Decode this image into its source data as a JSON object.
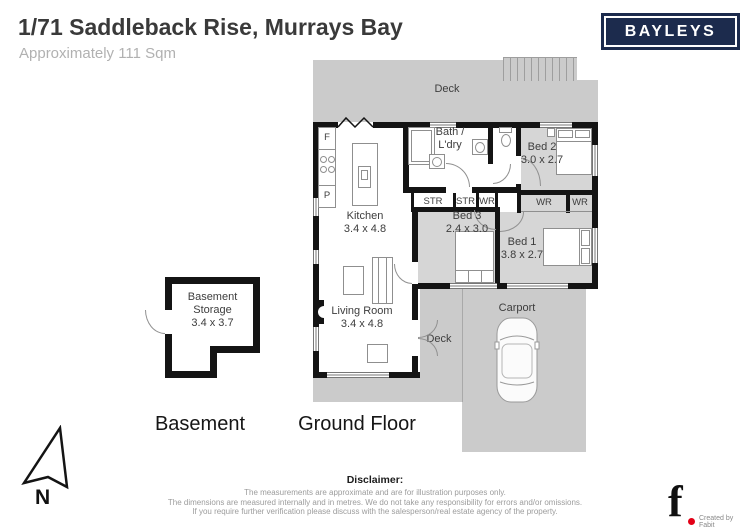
{
  "header": {
    "title": "1/71 Saddleback Rise, Murrays Bay",
    "subtitle": "Approximately 111 Sqm",
    "brand": "BAYLEYS"
  },
  "colors": {
    "brand_navy": "#1c2b4d",
    "deck_gray": "#cbcbcb",
    "room_gray": "#d6d6d6",
    "wall_black": "#141414",
    "accent_red": "#e30016"
  },
  "floors": {
    "ground_label": "Ground Floor",
    "basement_label": "Basement"
  },
  "rooms": {
    "kitchen": {
      "name": "Kitchen",
      "dims": "3.4 x 4.8"
    },
    "living": {
      "name": "Living Room",
      "dims": "3.4 x 4.8"
    },
    "bath": {
      "line1": "Bath /",
      "line2": "L'dry"
    },
    "bed1": {
      "name": "Bed 1",
      "dims": "3.8 x 2.7"
    },
    "bed2": {
      "name": "Bed 2",
      "dims": "3.0 x 2.7"
    },
    "bed3": {
      "name": "Bed 3",
      "dims": "2.4 x 3.0"
    },
    "deck_top": "Deck",
    "deck_bottom": "Deck",
    "carport": "Carport",
    "storage_row": {
      "str1": "STR",
      "str2": "STR",
      "wr": "WR"
    },
    "wardrobes": {
      "wr1": "WR",
      "wr2": "WR"
    },
    "appliances": {
      "fridge": "F",
      "pantry": "P"
    },
    "basement_storage": {
      "line1": "Basement",
      "line2": "Storage",
      "dims": "3.4 x 3.7"
    }
  },
  "compass": {
    "north_label": "N"
  },
  "footer": {
    "disclaimer_title": "Disclaimer:",
    "line1": "The measurements are approximate and are for illustration purposes only.",
    "line2": "The dimensions are measured internally and in metres. We do not take any responsibility for errors and/or omissions.",
    "line3": "If you require further verification please discuss with the salesperson/real estate agency of the property.",
    "credit_glyph": "f",
    "credit": "Created by Fabit"
  }
}
